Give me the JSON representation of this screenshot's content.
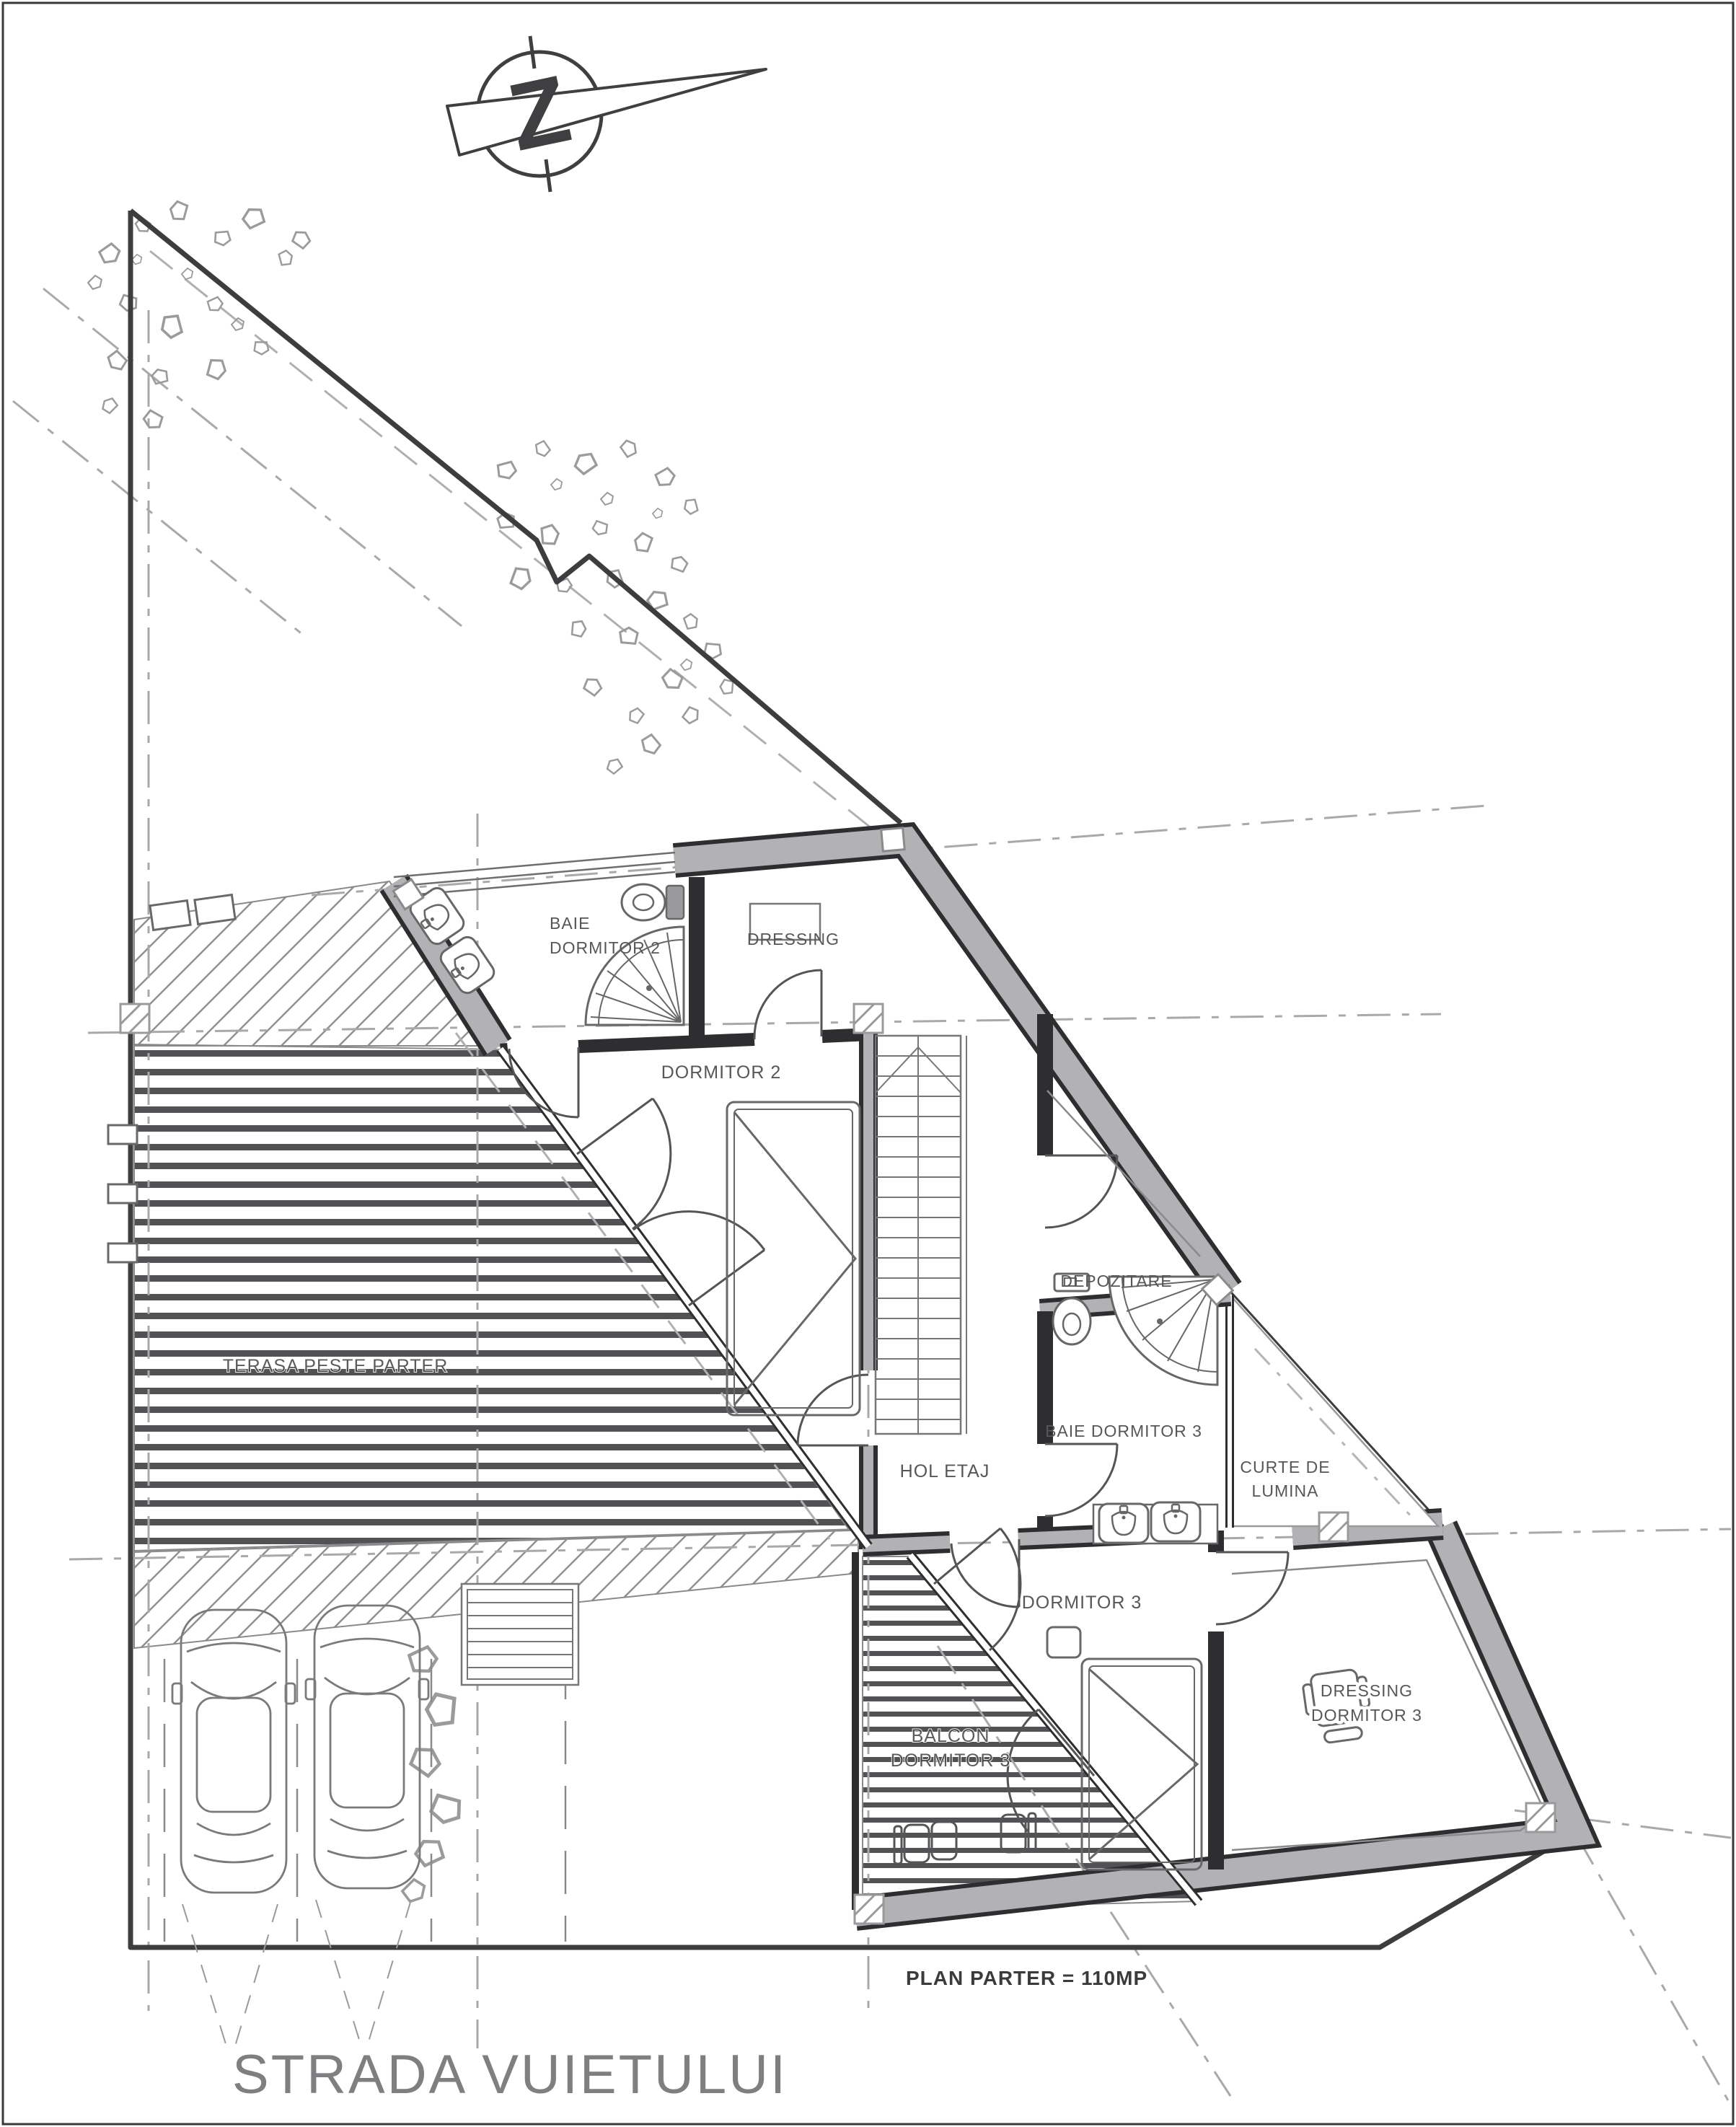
{
  "plan": {
    "title_note": "PLAN PARTER = 110MP",
    "street_label": "STRADA VUIETULUI",
    "north_letter": "Z",
    "rooms": {
      "baie_dormitor_2": {
        "line1": "BAIE",
        "line2": "DORMITOR 2"
      },
      "dressing": "DRESSING",
      "dormitor_2": "DORMITOR 2",
      "depozitare": "DEPOZITARE",
      "baie_dormitor_3": "BAIE DORMITOR 3",
      "curte_de_lumina": {
        "line1": "CURTE DE",
        "line2": "LUMINA"
      },
      "hol_etaj": "HOL ETAJ",
      "dormitor_3": "DORMITOR 3",
      "dressing_dormitor_3": {
        "line1": "DRESSING",
        "line2": "DORMITOR 3"
      },
      "terasa": "TERASA PESTE PARTER",
      "balcon": {
        "line1": "BALCON",
        "line2": "DORMITOR 3"
      }
    },
    "colors": {
      "wall_fill": "#b2b2b4",
      "line_dark": "#3d3d3f",
      "line_mid": "#6b6b6d",
      "grid_line": "#a9a9ab",
      "deck_stripe": "#525254",
      "hatch_line": "#909092",
      "label_text": "#57575a",
      "street_text": "#7f7f82"
    }
  }
}
